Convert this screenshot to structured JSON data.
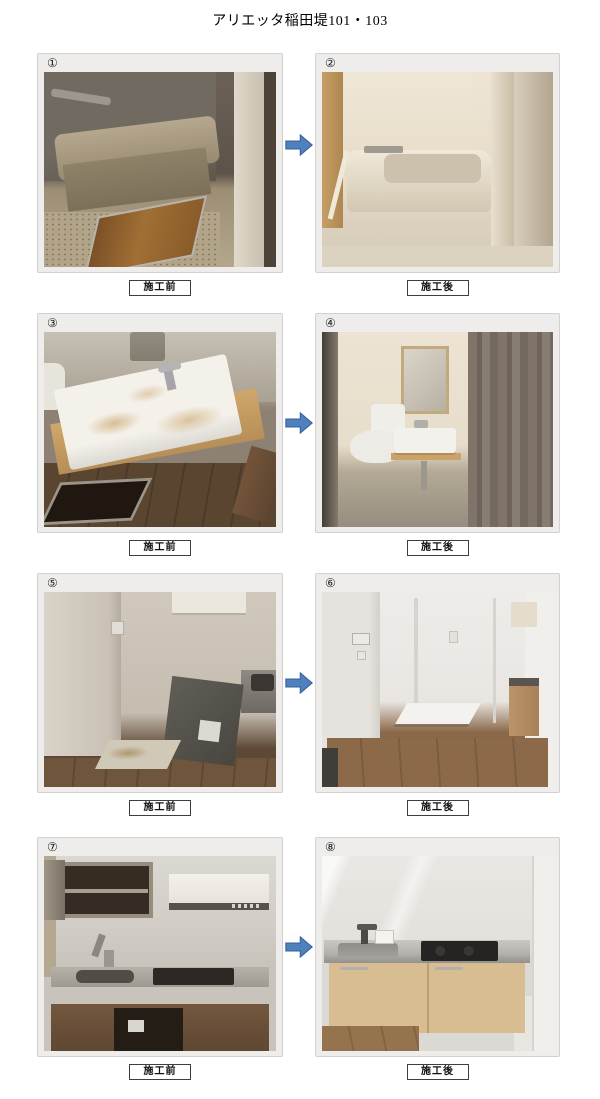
{
  "document": {
    "title": "アリエッタ稲田堤101・103"
  },
  "captions": {
    "before": "施工前",
    "after": "施工後"
  },
  "arrow": {
    "fill": "#4f81bd",
    "stroke": "#3a62a0"
  },
  "rows": [
    {
      "before": {
        "number": "①",
        "caption": "施工前",
        "scene": "bathtub-dirty"
      },
      "after": {
        "number": "②",
        "caption": "施工後",
        "scene": "bathtub-renovated"
      }
    },
    {
      "before": {
        "number": "③",
        "caption": "施工前",
        "scene": "washbasin-dirty"
      },
      "after": {
        "number": "④",
        "caption": "施工後",
        "scene": "washroom-renovated"
      }
    },
    {
      "before": {
        "number": "⑤",
        "caption": "施工前",
        "scene": "laundry-space-old"
      },
      "after": {
        "number": "⑥",
        "caption": "施工後",
        "scene": "laundry-space-renovated"
      }
    },
    {
      "before": {
        "number": "⑦",
        "caption": "施工前",
        "scene": "kitchen-old"
      },
      "after": {
        "number": "⑧",
        "caption": "施工後",
        "scene": "kitchen-renovated"
      }
    }
  ]
}
